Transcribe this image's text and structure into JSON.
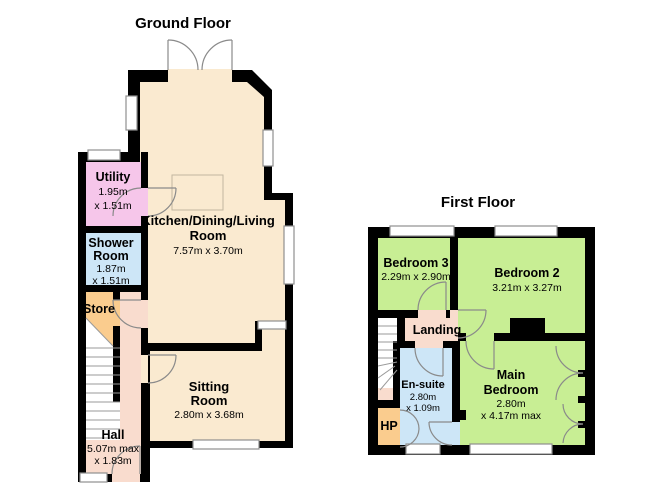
{
  "colors": {
    "wall": "#000000",
    "living_cream": "#FAEAD0",
    "hall_salmon": "#F9DCCE",
    "utility_pink": "#F6C6EA",
    "bath_blue": "#CDE6F7",
    "store_orange": "#FACC8E",
    "bedroom_green": "#C8EE94",
    "window_white": "#FFFFFF"
  },
  "ground_floor": {
    "title": "Ground Floor",
    "rooms": {
      "kitchen": {
        "lines": [
          "Kitchen/Dining/Living",
          "Room",
          "7.57m x 3.70m"
        ]
      },
      "utility": {
        "lines": [
          "Utility",
          "1.95m",
          "x 1.51m"
        ]
      },
      "shower": {
        "lines": [
          "Shower",
          "Room",
          "1.87m",
          "x 1.51m"
        ]
      },
      "store": {
        "lines": [
          "Store"
        ]
      },
      "hall": {
        "lines": [
          "Hall",
          "5.07m max",
          "x 1.83m"
        ]
      },
      "sitting": {
        "lines": [
          "Sitting",
          "Room",
          "2.80m x 3.68m"
        ]
      }
    }
  },
  "first_floor": {
    "title": "First Floor",
    "rooms": {
      "bedroom3": {
        "lines": [
          "Bedroom 3",
          "2.29m x 2.90m"
        ]
      },
      "bedroom2": {
        "lines": [
          "Bedroom 2",
          "3.21m x 3.27m"
        ]
      },
      "landing": {
        "lines": [
          "Landing"
        ]
      },
      "ensuite": {
        "lines": [
          "En-suite",
          "2.80m",
          "x 1.09m"
        ]
      },
      "hp": {
        "lines": [
          "HP"
        ]
      },
      "main_bedroom": {
        "lines": [
          "Main",
          "Bedroom",
          "2.80m",
          "x 4.17m max"
        ]
      }
    }
  }
}
